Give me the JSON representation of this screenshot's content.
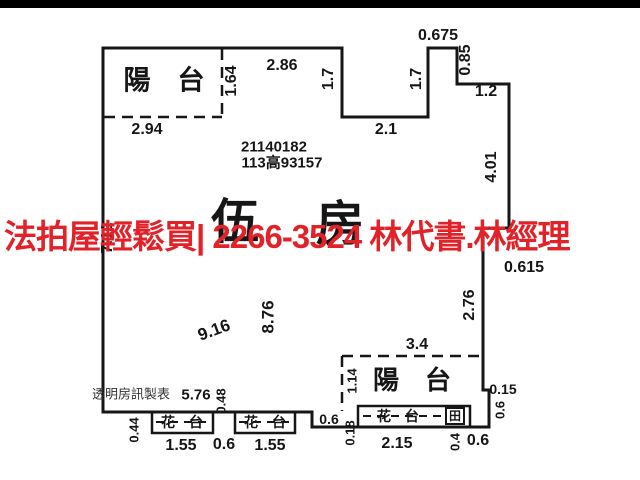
{
  "page": {
    "background": "#ffffff",
    "top_bar_color": "#000000"
  },
  "overlay": {
    "text": "法拍屋輕鬆買| 2266-3524  林代書.林經理",
    "color": "#e12228"
  },
  "plan": {
    "line_color": "#161616",
    "id_number": "21140182",
    "ref_number": "113高93157",
    "room_label": "伍房",
    "watermark": "透明房訊製表",
    "labels": [
      {
        "t": "陽　台",
        "x": 164,
        "y": 81,
        "s": 27,
        "name": "balcony-label-top"
      },
      {
        "t": "1.64",
        "x": 232,
        "y": 81,
        "r": -90,
        "s": 16
      },
      {
        "t": "2.86",
        "x": 282,
        "y": 66,
        "s": 16
      },
      {
        "t": "2.94",
        "x": 147,
        "y": 130,
        "s": 16
      },
      {
        "t": "1.7",
        "x": 329,
        "y": 79,
        "r": -90,
        "s": 16
      },
      {
        "t": "2.1",
        "x": 386,
        "y": 130,
        "s": 16
      },
      {
        "t": "1.7",
        "x": 417,
        "y": 79,
        "r": -90,
        "s": 16
      },
      {
        "t": "0.675",
        "x": 438,
        "y": 36,
        "s": 16
      },
      {
        "t": "0.85",
        "x": 466,
        "y": 60,
        "r": -90,
        "s": 16
      },
      {
        "t": "1.2",
        "x": 486,
        "y": 92,
        "s": 16
      },
      {
        "t": "4.01",
        "x": 492,
        "y": 167,
        "r": -90,
        "s": 16
      },
      {
        "t": "21140182",
        "x": 274,
        "y": 147,
        "s": 15,
        "name": "plan-id-number"
      },
      {
        "t": "113高93157",
        "x": 282,
        "y": 163,
        "s": 15,
        "name": "plan-ref-number"
      },
      {
        "t": "伍",
        "x": 235,
        "y": 222,
        "s": 48,
        "cls": "room",
        "name": "room-count-char-1"
      },
      {
        "t": "房",
        "x": 340,
        "y": 224,
        "s": 48,
        "cls": "room",
        "name": "room-count-char-2"
      },
      {
        "t": "7.12",
        "x": 108,
        "y": 238,
        "r": -90,
        "s": 16
      },
      {
        "t": "0.615",
        "x": 524,
        "y": 268,
        "s": 16
      },
      {
        "t": "2.76",
        "x": 470,
        "y": 305,
        "r": -90,
        "s": 16
      },
      {
        "t": "9.16",
        "x": 214,
        "y": 330,
        "r": -20,
        "s": 17
      },
      {
        "t": "8.76",
        "x": 268,
        "y": 317,
        "r": -90,
        "s": 17
      },
      {
        "t": "3.4",
        "x": 417,
        "y": 345,
        "s": 16
      },
      {
        "t": "1.14",
        "x": 352,
        "y": 381,
        "r": -90,
        "s": 13
      },
      {
        "t": "陽　台",
        "x": 412,
        "y": 380,
        "s": 26,
        "name": "balcony-label-bottom"
      },
      {
        "t": "0.15",
        "x": 503,
        "y": 389,
        "s": 14
      },
      {
        "t": "0.6",
        "x": 500,
        "y": 410,
        "r": -90,
        "s": 13
      },
      {
        "t": "透明房訊製表",
        "x": 131,
        "y": 394,
        "s": 13,
        "cls": "wm",
        "name": "watermark"
      },
      {
        "t": "5.76",
        "x": 196,
        "y": 395,
        "s": 15
      },
      {
        "t": "0.48",
        "x": 221,
        "y": 401,
        "r": -90,
        "s": 13
      },
      {
        "t": "0.44",
        "x": 134,
        "y": 430,
        "r": -90,
        "s": 13
      },
      {
        "t": "花　台",
        "x": 182,
        "y": 422,
        "s": 14,
        "name": "planter-label-1"
      },
      {
        "t": "花　台",
        "x": 265,
        "y": 422,
        "s": 14,
        "name": "planter-label-2"
      },
      {
        "t": "1.55",
        "x": 181,
        "y": 446,
        "s": 16
      },
      {
        "t": "0.6",
        "x": 224,
        "y": 445,
        "s": 16
      },
      {
        "t": "1.55",
        "x": 270,
        "y": 446,
        "s": 16
      },
      {
        "t": "0.6",
        "x": 329,
        "y": 419,
        "s": 14
      },
      {
        "t": "0.18",
        "x": 350,
        "y": 433,
        "r": -90,
        "s": 13
      },
      {
        "t": "花　台",
        "x": 398,
        "y": 416,
        "s": 14,
        "name": "planter-label-3"
      },
      {
        "t": "田",
        "x": 455,
        "y": 416,
        "s": 12,
        "name": "window-symbol"
      },
      {
        "t": "2.15",
        "x": 397,
        "y": 444,
        "s": 16
      },
      {
        "t": "0.4",
        "x": 455,
        "y": 442,
        "r": -90,
        "s": 13
      },
      {
        "t": "0.6",
        "x": 478,
        "y": 441,
        "s": 16
      }
    ]
  }
}
